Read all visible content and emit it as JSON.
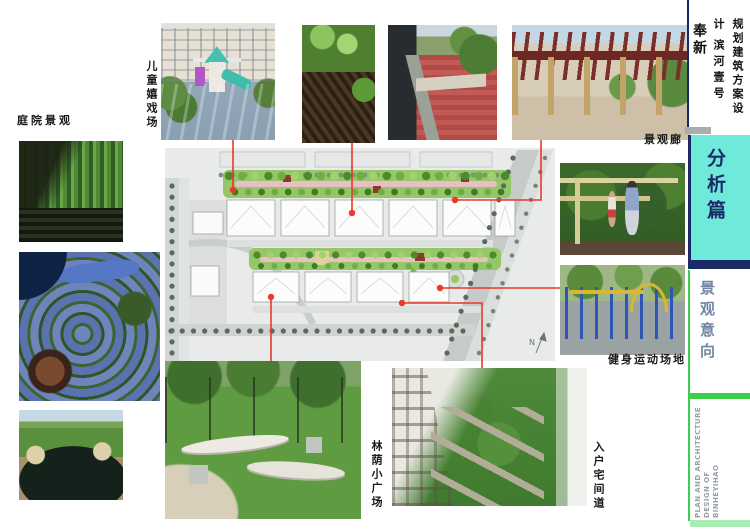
{
  "header": {
    "project": "奉新",
    "project_subtitle": "滨河壹号",
    "doc_type": "规划建筑方案设计"
  },
  "sidebar": {
    "section_title": "分析篇",
    "section_subtitle": "景观意向",
    "footer_line1": "PLAN AND ARCHITECTURE",
    "footer_line2": "DESIGN OF",
    "footer_line3": "BINHEYIHAO",
    "colors": {
      "teal": "#6FE9D9",
      "navy": "#1B2A66",
      "green": "#3ECF4A",
      "light_green": "#A9ECB4",
      "subtitle_blue": "#7385A5",
      "footer_gray": "#99A1A8"
    }
  },
  "labels": {
    "courtyard": "庭院景观",
    "children_playground": "儿童嬉戏场",
    "landscape_corridor": "景观廊",
    "fitness_area": "健身运动场地",
    "tree_plaza": "林荫小广场",
    "entry_path": "入户宅间道"
  },
  "plan": {
    "compass": "N",
    "connector_color": "#E8392B"
  }
}
